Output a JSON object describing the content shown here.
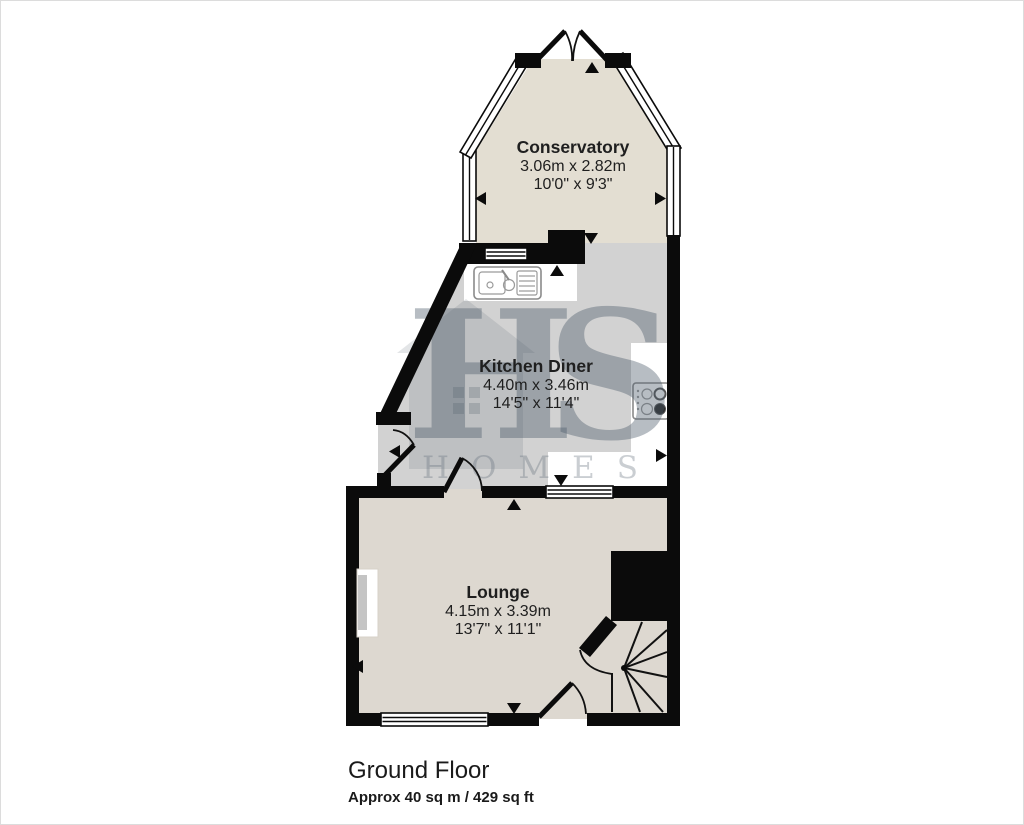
{
  "page": {
    "background": "#ffffff",
    "border_color": "#dcdcdc"
  },
  "floorplan": {
    "footer": {
      "title": "Ground Floor",
      "area": "Approx 40 sq m / 429 sq ft"
    },
    "rooms": [
      {
        "name": "Conservatory",
        "metric": "3.06m x 2.82m",
        "imperial": "10'0\" x 9'3\""
      },
      {
        "name": "Kitchen Diner",
        "metric": "4.40m x 3.46m",
        "imperial": "14'5\" x 11'4\""
      },
      {
        "name": "Lounge",
        "metric": "4.15m x 3.39m",
        "imperial": "13'7\" x 11'1\""
      }
    ],
    "watermark": {
      "initials": "HS",
      "word": "HOMES"
    },
    "colors": {
      "wall": "#0b0b0b",
      "conservatory_floor": "#e3ded2",
      "kitchen_floor": "#d2d2d2",
      "lounge_floor": "#ddd8d0",
      "counter": "#ffffff",
      "label_text": "#1f1f1f",
      "footer_text": "#1a1a1a",
      "watermark_initials": "rgba(76,91,106,0.40)",
      "watermark_word": "rgba(100,112,124,0.34)",
      "watermark_house": "rgba(100,110,120,0.18)",
      "watermark_house_window": "rgba(100,110,120,0.30)"
    },
    "features": {
      "sink": "sink-icon",
      "hob": "hob-icon",
      "stairs": "winder-staircase",
      "fireplace": "fireplace-recess"
    }
  }
}
